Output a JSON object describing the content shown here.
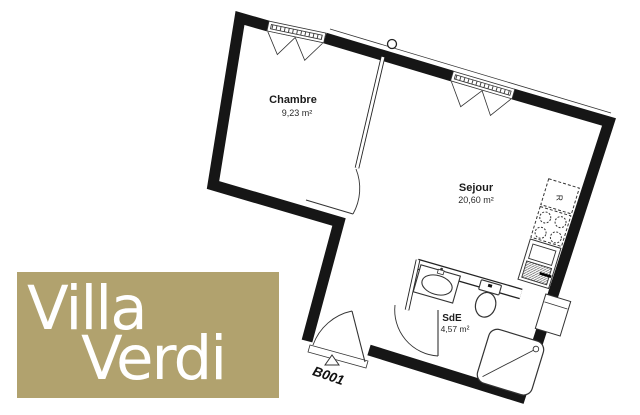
{
  "logo": {
    "word1": "Villa",
    "word2": "Verdi",
    "background_color": "#b1a26e",
    "text_color": "#ffffff"
  },
  "rooms": {
    "chambre": {
      "name": "Chambre",
      "area": "9,23 m²"
    },
    "sejour": {
      "name": "Sejour",
      "area": "20,60 m²"
    },
    "sde": {
      "name": "SdE",
      "area": "4,57 m²"
    }
  },
  "unit_label": "B001",
  "kitchen": {
    "fridge_label": "R"
  },
  "colors": {
    "wall": "#161616",
    "line": "#2a2a2a",
    "background": "#ffffff"
  }
}
